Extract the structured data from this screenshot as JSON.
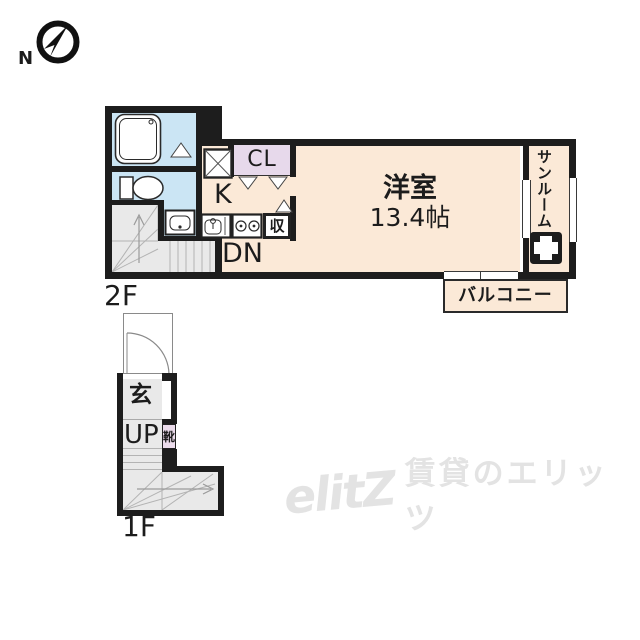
{
  "compass": {
    "north": "N"
  },
  "floor2": {
    "label": "2F",
    "main_room_name": "洋室",
    "main_room_size": "13.4帖",
    "kitchen": "K",
    "closet": "CL",
    "storage": "収",
    "sunroom": "サンルーム",
    "balcony": "バルコニー",
    "stairs_down": "DN"
  },
  "floor1": {
    "label": "1F",
    "entrance": "玄",
    "stairs_up": "UP",
    "shoe_cabinet": "靴"
  },
  "watermark": {
    "logo": "elitZ",
    "brand": "賃貸のエリッツ"
  },
  "colors": {
    "wall": "#1d1d1d",
    "floor": "#fbe9d7",
    "wet_area": "#cbe5f4",
    "closet": "#e7d9eb",
    "stairs": "#e9e9e9",
    "watermark": "#e3e3e3"
  }
}
